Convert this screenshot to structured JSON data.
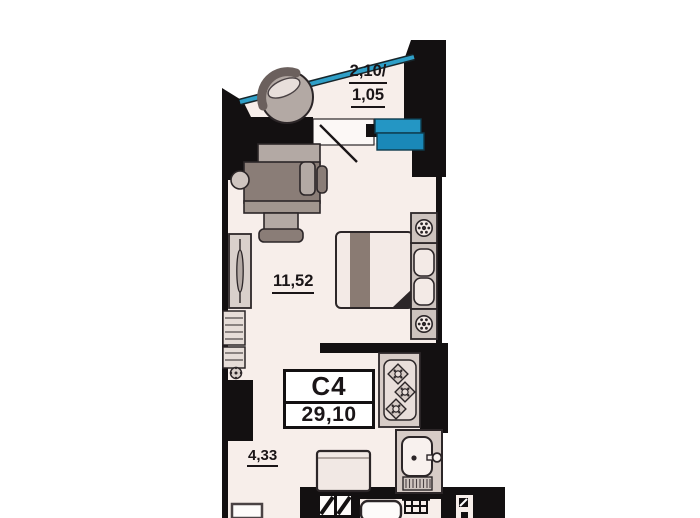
{
  "unit_card": {
    "code": "C4",
    "total_area": "29,10"
  },
  "room_labels": {
    "balcony_line1": "2,10/",
    "balcony_line2": "1,05",
    "living_area": "11,52",
    "kitchen_hall_area": "4,33"
  },
  "colors": {
    "wall": "#131011",
    "floor": "#f7eeea",
    "threshold": "#fcf8f6",
    "glazing_blue": "#2f9fc7",
    "window_blue_top": "#2496c4",
    "window_blue_bottom": "#1a88b8",
    "furniture_dark": "#8a7d77",
    "furniture_light": "#b3a9a4",
    "cabinet_light": "#d9d0cb"
  },
  "icons": {
    "armchair-icon": "round armchair: circle with backrest arc",
    "desk-icon": "desk with office chair and stool",
    "wardrobe-icon": "sliding wardrobe with lens handle",
    "shelving-icon": "shelf cabinets",
    "plant-icon": "small potted plant",
    "bed-icon": "double bed with throw stripe and folded corner",
    "nightstand-icon": "bedside table",
    "lamp-icon": "table lamp: circle with radial dots",
    "stove-icon": "cooktop with three diamond burners",
    "sink-icon": "kitchen sink with faucet and drainer",
    "fridge-icon": "refrigerator",
    "door-swing-icon": "door opening with swing line",
    "window-icon": "blue balcony window block",
    "glazing-icon": "blue balcony glazing line",
    "door-leaf-icon": "door leaf hatch marks",
    "bathtub-icon": "rounded tub outline (cut off)",
    "table-icon": "small grid table (cut off)"
  }
}
